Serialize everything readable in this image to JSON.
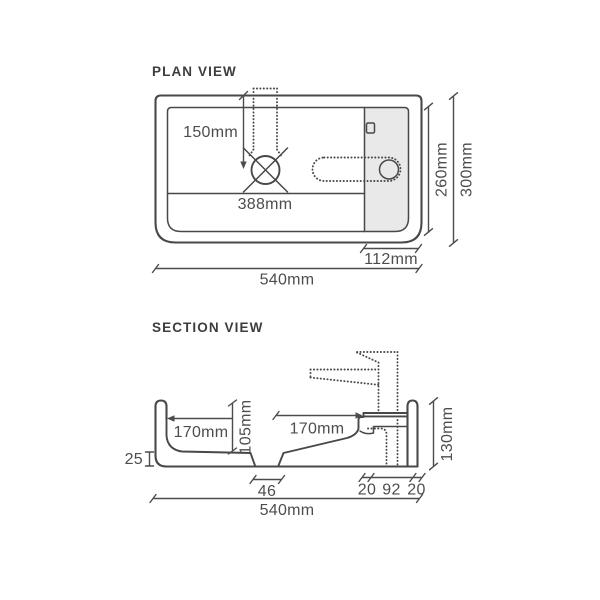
{
  "colors": {
    "background": "#ffffff",
    "line": "#484848",
    "text": "#4d4d4d",
    "deck_fill": "#e9e9e9"
  },
  "plan_view": {
    "title": "PLAN VIEW",
    "dims": {
      "tap_centre_offset": "150mm",
      "bowl_width": "388mm",
      "inner_depth": "260mm",
      "overall_depth": "300mm",
      "tap_deck_width": "112mm",
      "overall_width": "540mm"
    }
  },
  "section_view": {
    "title": "SECTION VIEW",
    "dims": {
      "bowl_left_half": "170mm",
      "bowl_depth": "105mm",
      "bowl_right_half": "170mm",
      "overall_height": "130mm",
      "base_thickness": "25",
      "waste_width": "46",
      "deck_segments": [
        "20",
        "92",
        "20"
      ],
      "overall_width": "540mm"
    }
  }
}
